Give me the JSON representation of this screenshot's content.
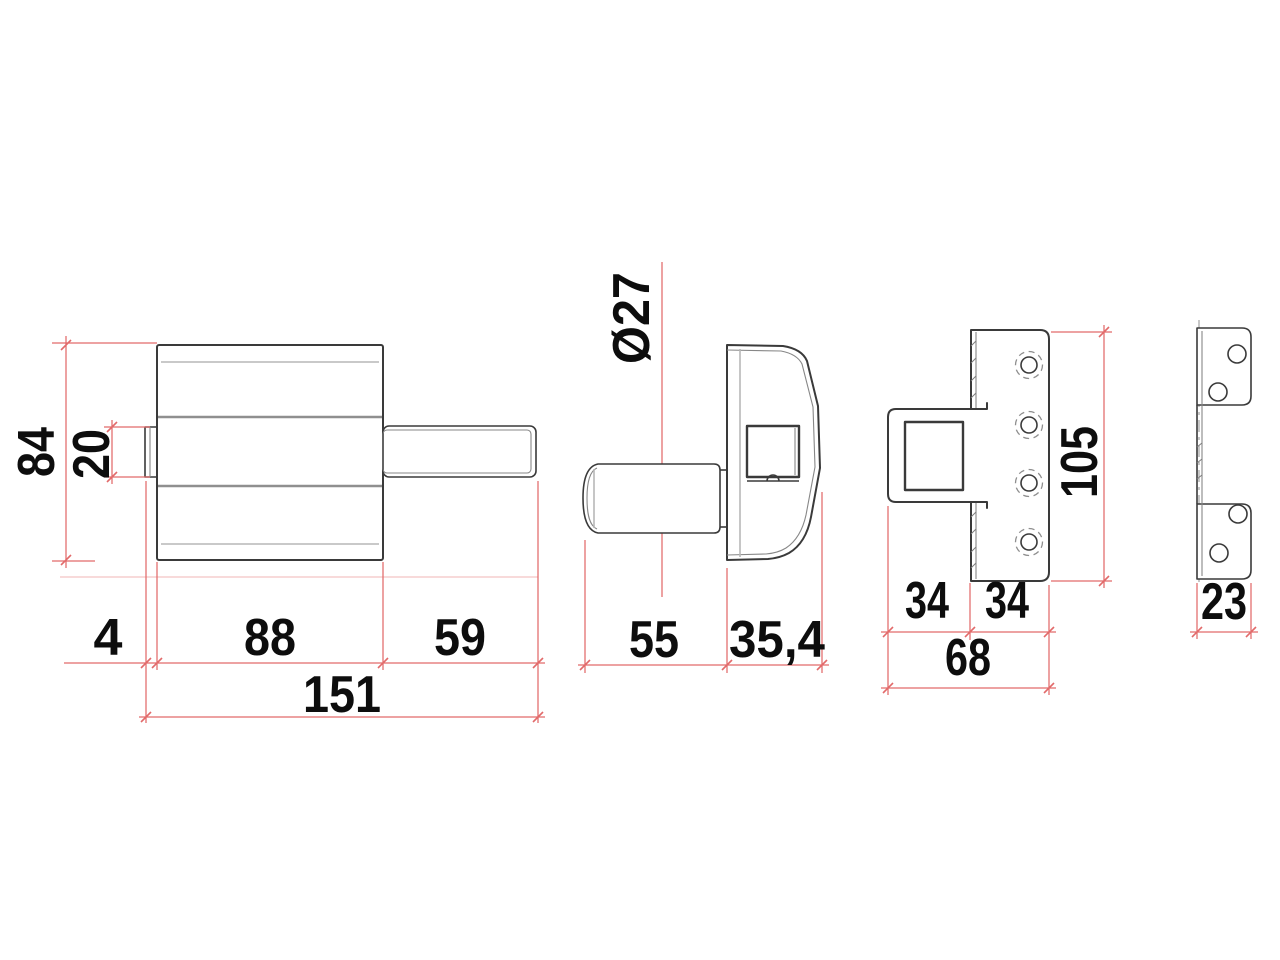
{
  "drawing": {
    "type": "orthographic-technical-drawing",
    "subject": "lock-with-strike-plate",
    "views": [
      {
        "name": "lock-front-view",
        "dimension_labels": [
          "84",
          "20",
          "4",
          "88",
          "59",
          "151"
        ]
      },
      {
        "name": "lock-side-view",
        "dimension_labels": [
          "Ø27",
          "55",
          "35,4"
        ]
      },
      {
        "name": "strike-plate-front-view",
        "dimension_labels": [
          "34",
          "34",
          "68",
          "105"
        ]
      },
      {
        "name": "strike-plate-side-view",
        "dimension_labels": [
          "23"
        ]
      }
    ],
    "labels": {
      "d84": "84",
      "d20": "20",
      "d4": "4",
      "d88": "88",
      "d59": "59",
      "d151": "151",
      "d27": "Ø27",
      "d55": "55",
      "d354": "35,4",
      "d34a": "34",
      "d34b": "34",
      "d68": "68",
      "d105": "105",
      "d23": "23"
    }
  },
  "colors": {
    "outline": "#3a3a3a",
    "dimension_line": "#e26a6a",
    "dimension_faint": "#f2b4b4",
    "label": "#0d0d0d",
    "background": "#ffffff"
  }
}
